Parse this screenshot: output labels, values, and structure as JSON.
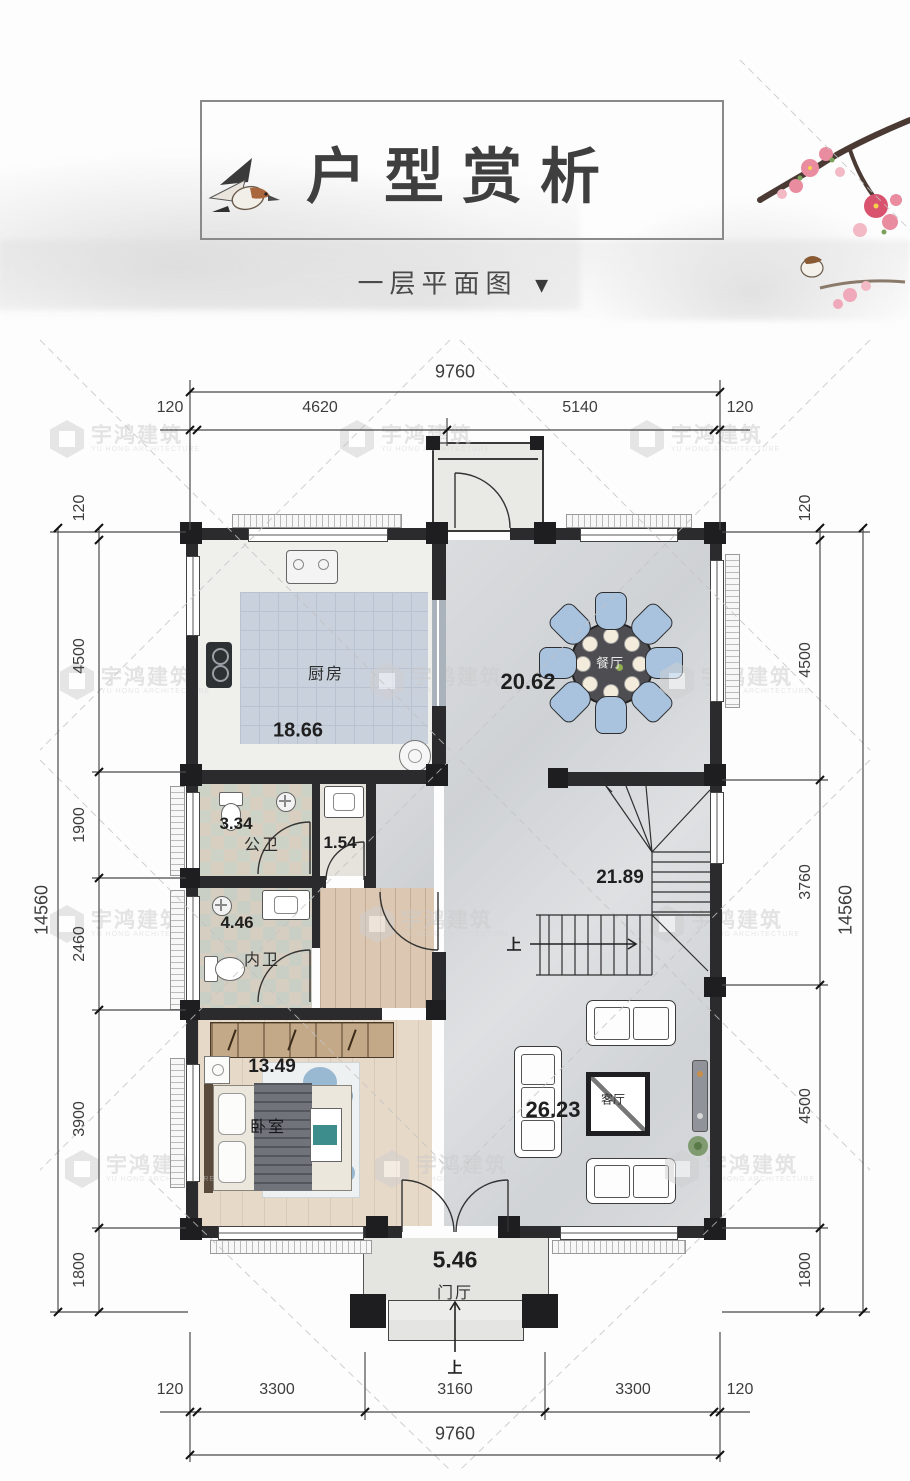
{
  "header": {
    "title": "户型赏析",
    "subtitle": "一层平面图",
    "subtitle_arrow": "▼"
  },
  "watermark": {
    "name_cn": "宇鸿建筑",
    "name_en": "YU HONG ARCHITECTURE"
  },
  "rooms": {
    "kitchen": {
      "name": "厨房",
      "area": "18.66"
    },
    "dining": {
      "name": "餐厅",
      "area": "20.62"
    },
    "public_bath": {
      "name": "公卫",
      "area": "3.34"
    },
    "wash_nook": {
      "area": "1.54"
    },
    "master_bath": {
      "name": "内卫",
      "area": "4.46"
    },
    "bedroom": {
      "name": "卧室",
      "area": "13.49"
    },
    "living": {
      "name": "客厅",
      "area": "26.23"
    },
    "stairs": {
      "area": "21.89",
      "up": "上"
    },
    "foyer": {
      "name": "门厅",
      "area": "5.46",
      "up": "上"
    }
  },
  "dims": {
    "top": {
      "overall": "9760",
      "segments": [
        "120",
        "4620",
        "5140",
        "120"
      ]
    },
    "bottom": {
      "overall": "9760",
      "segments": [
        "120",
        "3300",
        "3160",
        "3300",
        "120"
      ]
    },
    "left": {
      "overall": "14560",
      "segments": [
        "120",
        "4500",
        "1900",
        "2460",
        "3900",
        "1800"
      ]
    },
    "right": {
      "overall": "14560",
      "segments": [
        "120",
        "4500",
        "3760",
        "4500",
        "1800"
      ]
    }
  },
  "colors": {
    "wall": "#2b2b2e",
    "chair_blue": "#a9c3de",
    "kitchen_tile": "#c9d1dd",
    "marble_floor": "#d6d8da",
    "wood_floor": "#dcc8b2",
    "accent_pink": "#e98ca0"
  }
}
